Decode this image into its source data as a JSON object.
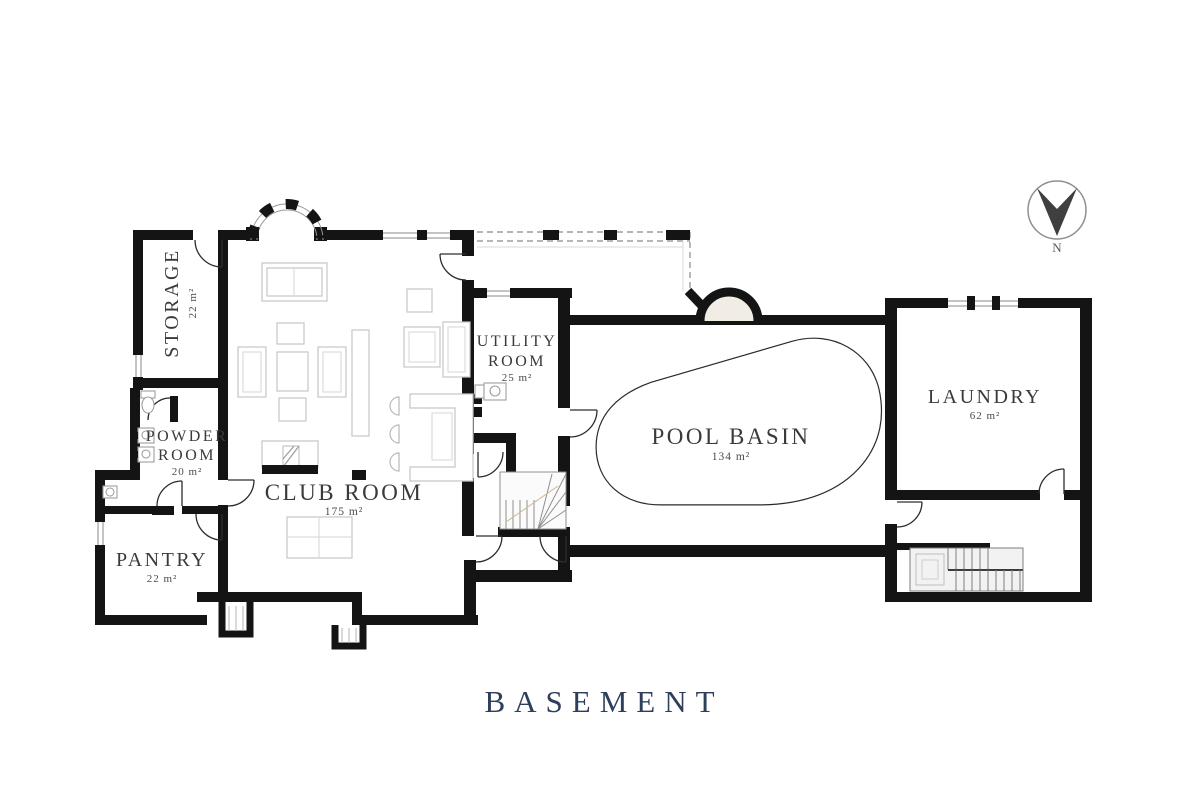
{
  "title": "BASEMENT",
  "compass": {
    "label": "N"
  },
  "rooms": {
    "storage": {
      "name": "STORAGE",
      "area": "22 m²"
    },
    "powder": {
      "line1": "POWDER",
      "line2": "ROOM",
      "area": "20 m²"
    },
    "pantry": {
      "name": "PANTRY",
      "area": "22 m²"
    },
    "club": {
      "name": "CLUB ROOM",
      "area": "175 m²"
    },
    "utility": {
      "line1": "UTILITY",
      "line2": "ROOM",
      "area": "25 m²"
    },
    "pool": {
      "name": "POOL BASIN",
      "area": "134 m²"
    },
    "laundry": {
      "name": "LAUNDRY",
      "area": "62 m²"
    }
  },
  "colors": {
    "wall": "#141414",
    "furniture": "#c6c6c6",
    "title": "#2e3f5c",
    "label": "#3a3a3a"
  }
}
